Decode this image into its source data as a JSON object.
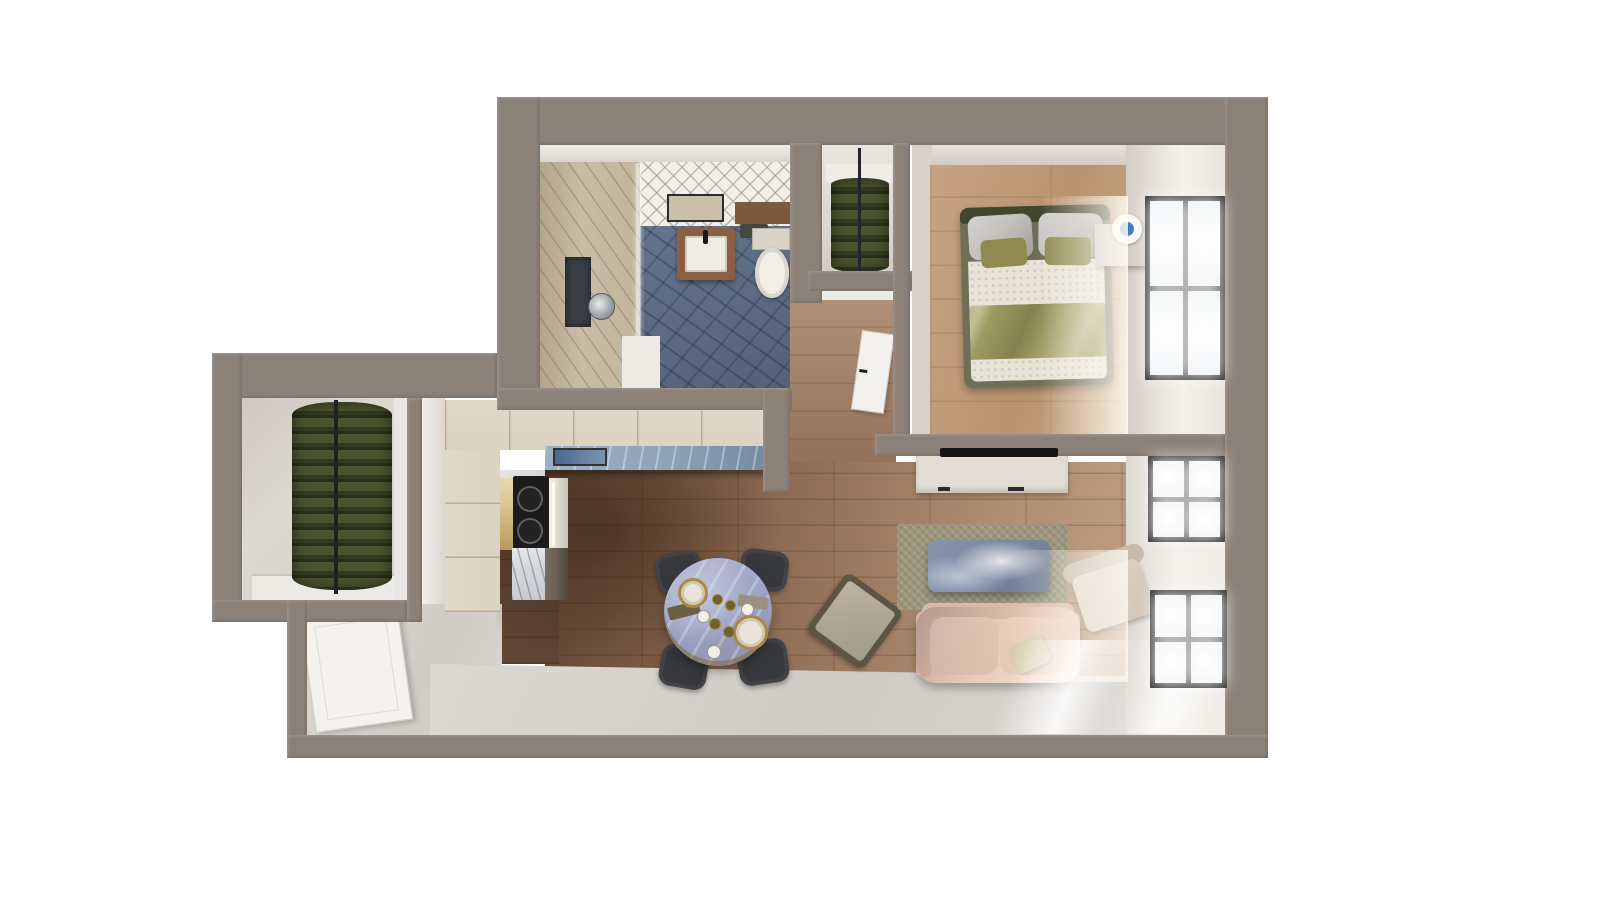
{
  "image_type": "3d-floorplan-top-down-render",
  "visible_text": [],
  "palette": {
    "wall": "#8B8177",
    "face": "#EDEAE5",
    "faceShade": "#D8D2CB",
    "woodDark": "#5E4534",
    "woodLight": "#C09E81",
    "bedWood": "#C7A384",
    "entryFloor": "#D9D5D0",
    "bathBlue": "#5A6880",
    "herring": "#F2EFE9",
    "showerTile": "#C9BCA5",
    "niche": "#3A3F45",
    "vanityWood": "#8A5F43",
    "basin": "#EFECE4",
    "toiletWhite": "#F1EEE7",
    "tankBeige": "#D9D3C7",
    "shelfWood": "#7C5A3E",
    "clothes": "#4A5330",
    "clothesDark": "#272E19",
    "rail": "#23262A",
    "baseboard": "#ECEAE5",
    "cabinet": "#DCD3C3",
    "counterBlue": "#8FA3B6",
    "artBlue": "#49698F",
    "stoveBlack": "#1B1B1B",
    "stainless": "#E6E3D8",
    "goldTrim": "#D8C490",
    "marble": "#D6D9DC",
    "darkCab": "#6B5F55",
    "tableMarble": "#9AA1C4",
    "chair": "#36383B",
    "plateGold": "#A8893F",
    "plateFill": "#E9E4D7",
    "bowl": "#6F602F",
    "cup": "#F2EFE8",
    "trayDark": "#6A6145",
    "trayLight": "#99937D",
    "stoolSeat": "#AEA695",
    "stoolFrame": "#5E5444",
    "rug": "#A7A089",
    "coffee": "#76849C",
    "sofa": "#E7CBBA",
    "sofaShade": "#D9B9A7",
    "pillowSage": "#CBC5A4",
    "armchairSeat": "#D8CFC0",
    "console": "#E2DDD3",
    "tv": "#161616",
    "frameBlack": "#1F1F1F",
    "door": "#F3F1ED",
    "bedFrame": "#6F6E56",
    "headboard": "#43462F",
    "pillowSatin": "#C4C2BD",
    "pillowAccent": "#8E8A52",
    "sheet": "#E7E3D6",
    "duvet": "#9E9A61",
    "nightstand": "#D5CFC6",
    "vase": "#3E7EC0"
  },
  "scene": {
    "rooms": [
      {
        "id": "bathroom",
        "features": [
          "shower-area",
          "glass-divider",
          "shower-head",
          "wall-niche",
          "vanity-sink",
          "mirror-cabinet",
          "wall-shelf",
          "towel",
          "toilet",
          "blue-tile-floor",
          "herringbone-tile-wall"
        ]
      },
      {
        "id": "wardrobe-closet",
        "features": [
          "hanging-clothes",
          "closet-rod",
          "shelf"
        ]
      },
      {
        "id": "bedroom",
        "features": [
          "double-bed",
          "satin-pillows",
          "accent-pillows",
          "duvet",
          "nightstand",
          "blue-vase",
          "window",
          "sunlight"
        ]
      },
      {
        "id": "hallway",
        "features": [
          "bedroom-door",
          "wood-floor"
        ]
      },
      {
        "id": "walk-in-closet",
        "features": [
          "hanging-clothes",
          "closet-rod",
          "baseboard"
        ]
      },
      {
        "id": "kitchen",
        "features": [
          "cabinets",
          "blue-counter",
          "backsplash-art",
          "cooktop",
          "oven",
          "marble-counter-end"
        ]
      },
      {
        "id": "dining-area",
        "features": [
          "round-marble-table",
          "four-chairs",
          "plates",
          "bowls",
          "cups",
          "serving-trays",
          "stool"
        ]
      },
      {
        "id": "living-room",
        "features": [
          "tv",
          "tv-console",
          "rug",
          "marble-coffee-table",
          "loveseat-sofa",
          "throw-pillow",
          "armchair",
          "two-windows",
          "sunlight"
        ]
      },
      {
        "id": "entry",
        "features": [
          "entry-door",
          "concrete-floor"
        ]
      }
    ]
  }
}
